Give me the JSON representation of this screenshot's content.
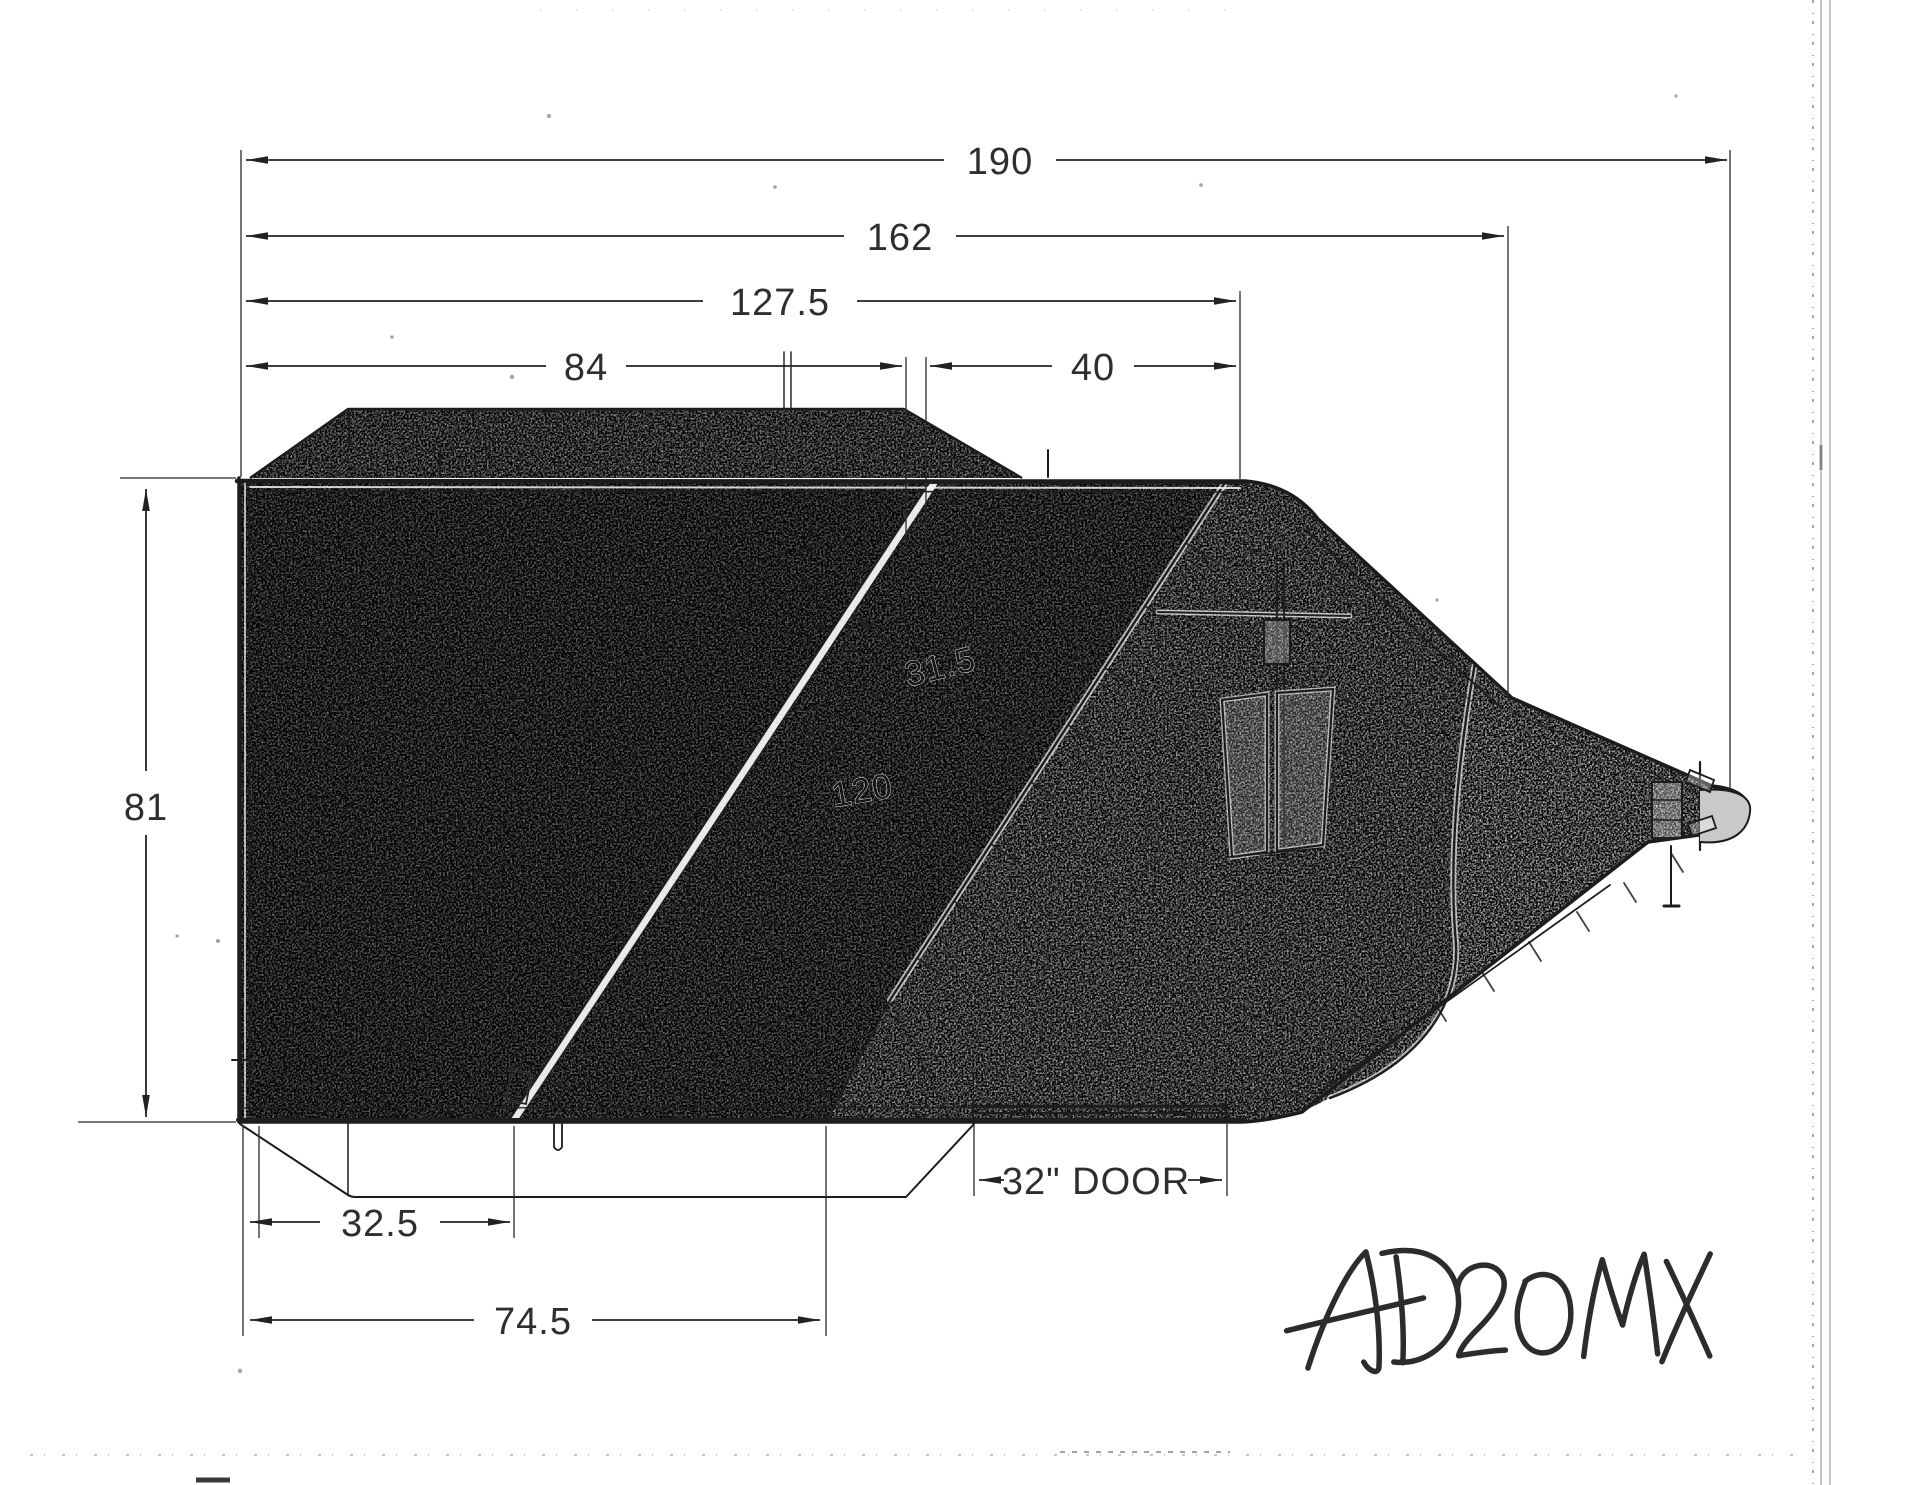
{
  "drawing": {
    "model_number": "AD20MX",
    "dimensions": {
      "overall_length": "190",
      "deck_to_hitch_length": "162",
      "upper_body_length": "127.5",
      "tarp_top_length": "84",
      "front_slope_top_length": "40",
      "side_height": "81",
      "slope_panel_width": "31.5",
      "floor_length": "120",
      "rear_frame_length": "32.5",
      "underframe_length": "74.5",
      "door_width_label": "32\" DOOR"
    },
    "colors": {
      "ink": "#1e1e1e",
      "paper": "#ffffff",
      "dark_fill_zone": "#707070",
      "mid_fill_zone": "#787878",
      "light_fill_zone": "#b4b4b4",
      "neck_fill_zone": "#cfcfcf",
      "tarp_fill_zone": "#9a9a9a"
    }
  }
}
